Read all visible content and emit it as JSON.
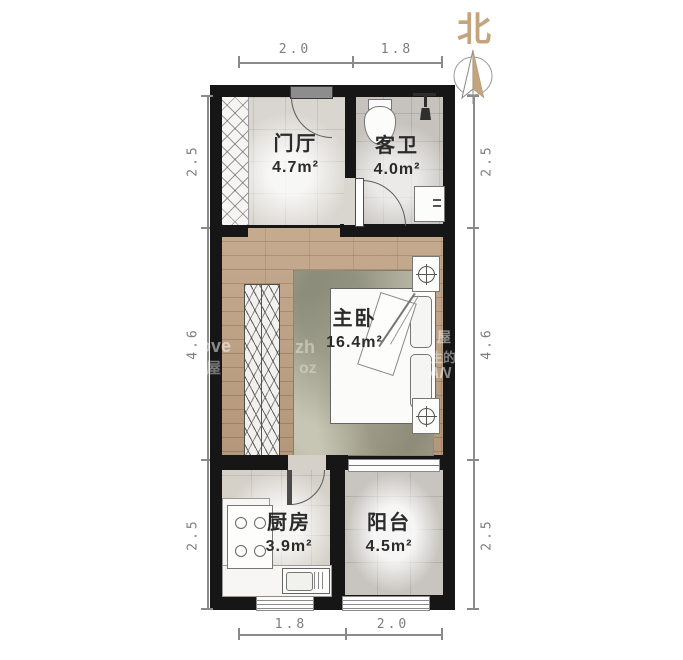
{
  "plan": {
    "type": "apartment-floor-plan"
  },
  "compass": {
    "label": "北"
  },
  "rooms": {
    "hall": {
      "name": "门厅",
      "area": "4.7m²"
    },
    "bath": {
      "name": "客卫",
      "area": "4.0m²"
    },
    "bedroom": {
      "name": "主卧",
      "area": "16.4m²"
    },
    "kitchen": {
      "name": "厨房",
      "area": "3.9m²"
    },
    "balcony": {
      "name": "阳台",
      "area": "4.5m²"
    }
  },
  "dimensions": {
    "top": [
      "2.0",
      "1.8"
    ],
    "bottom": [
      "1.8",
      "2.0"
    ],
    "left": [
      "2.5",
      "4.6",
      "2.5"
    ],
    "right": [
      "2.5",
      "4.6",
      "2.5"
    ]
  },
  "watermark": [
    "ove",
    "屋",
    "zh",
    "oz",
    "屋",
    "生的",
    "AN"
  ],
  "colors": {
    "wall": "#161616",
    "wood_floor": "#bfa183",
    "north_accent": "#c4a47c",
    "dimension": "#8a8a8a"
  }
}
